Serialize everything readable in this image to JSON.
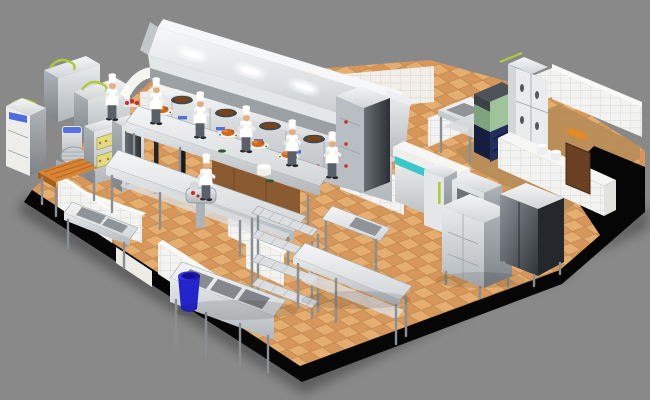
{
  "scene": {
    "description": "3D cutaway rendering of a commercial restaurant kitchen with chefs at a wok cooking line under an exhaust hood, prep tables with roasted poultry, ovens and mixer corner, warewash sinks, cold room with refrigerators and ice machine, shelving and steel cabinets on an orange tiled floor",
    "background_color": "#898989",
    "palette": {
      "floor_tile_light": "#E5AE70",
      "floor_tile_dark": "#D8975A",
      "floor_grout": "#C08A50",
      "wood_floor": "#B98E58",
      "wall_white": "#F3F3F1",
      "wall_grout": "#E0E0DD",
      "cut_edge_black": "#060606",
      "steel_light": "#EDEFF0",
      "steel_mid": "#C7CBCE",
      "steel_dark": "#868B90",
      "hood_glow": "#FFFFFF",
      "chef_uniform": "#FFFFFF",
      "chef_skin": "#E3AC82",
      "chef_pants": "#5A6068",
      "wok_food_brown": "#7A4418",
      "roast_duck_orange": "#CE6A1E",
      "butcher_wood": "#D98432",
      "door_wood": "#6B3F22",
      "accent_teal": "#38C8CC",
      "accent_lime": "#AECB3A",
      "ice_machine_green": "#9FC49A",
      "cabinet_navy": "#232E5C",
      "trash_bin_blue": "#2424CC",
      "oven_glow_yellow": "#DFDB7E",
      "indicator_red": "#CC2A2A",
      "indicator_blue": "#3355DD"
    },
    "counts": {
      "chefs": 7,
      "wok_stations": 5,
      "hood_lights": 4,
      "roast_platters": 4,
      "sink_bowls": 3,
      "shelf_tiers": 4,
      "upright_fridge_doors": 4
    },
    "areas": [
      {
        "id": "cooking-line",
        "label": "Wok cooking line under exhaust hood"
      },
      {
        "id": "prep-area",
        "label": "Central prep tables with roast poultry"
      },
      {
        "id": "bakery-corner",
        "label": "Dough mixer, deck oven, rack oven, butcher block"
      },
      {
        "id": "warewash-area",
        "label": "Triple sink, wall sink and waste bin"
      },
      {
        "id": "cold-room",
        "label": "Upright fridge, ice machine, prep sink"
      },
      {
        "id": "storage-area",
        "label": "Wire shelving, worktables, steel cabinets"
      }
    ],
    "equipment": [
      "exhaust-hood",
      "wok-range",
      "steamer-cabinet",
      "prep-counter",
      "prep-table",
      "dish-wash-stations",
      "dough-mixer",
      "deck-oven",
      "rack-oven",
      "butcher-block-table",
      "upright-fridge-4-door",
      "ice-machine",
      "pass-window",
      "reach-in-fridge",
      "tall-fridge",
      "open-steel-cabinet",
      "wire-shelving-rack",
      "triple-sink",
      "wall-sink",
      "sink-table",
      "long-worktable",
      "steel-cabinets",
      "trash-bin",
      "wooden-door",
      "doorway-frame",
      "meat-grinder",
      "rice-pot",
      "service-counter"
    ]
  }
}
